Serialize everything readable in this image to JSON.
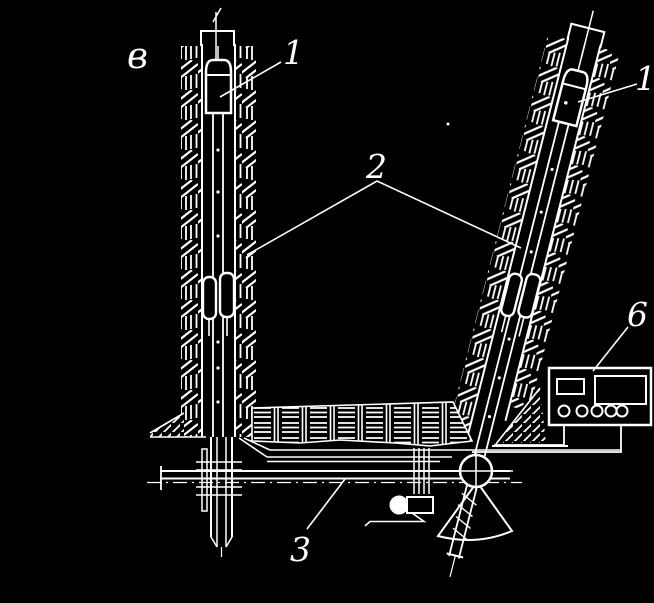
{
  "figure": {
    "background": "#000000",
    "ink": "#ffffff",
    "type": "borehole-inclinometer-survey-diagram"
  },
  "labels": {
    "panel": "в",
    "probe_left": "1",
    "probe_right": "1",
    "sensors": "2",
    "rod": "3",
    "instrument": "6"
  }
}
